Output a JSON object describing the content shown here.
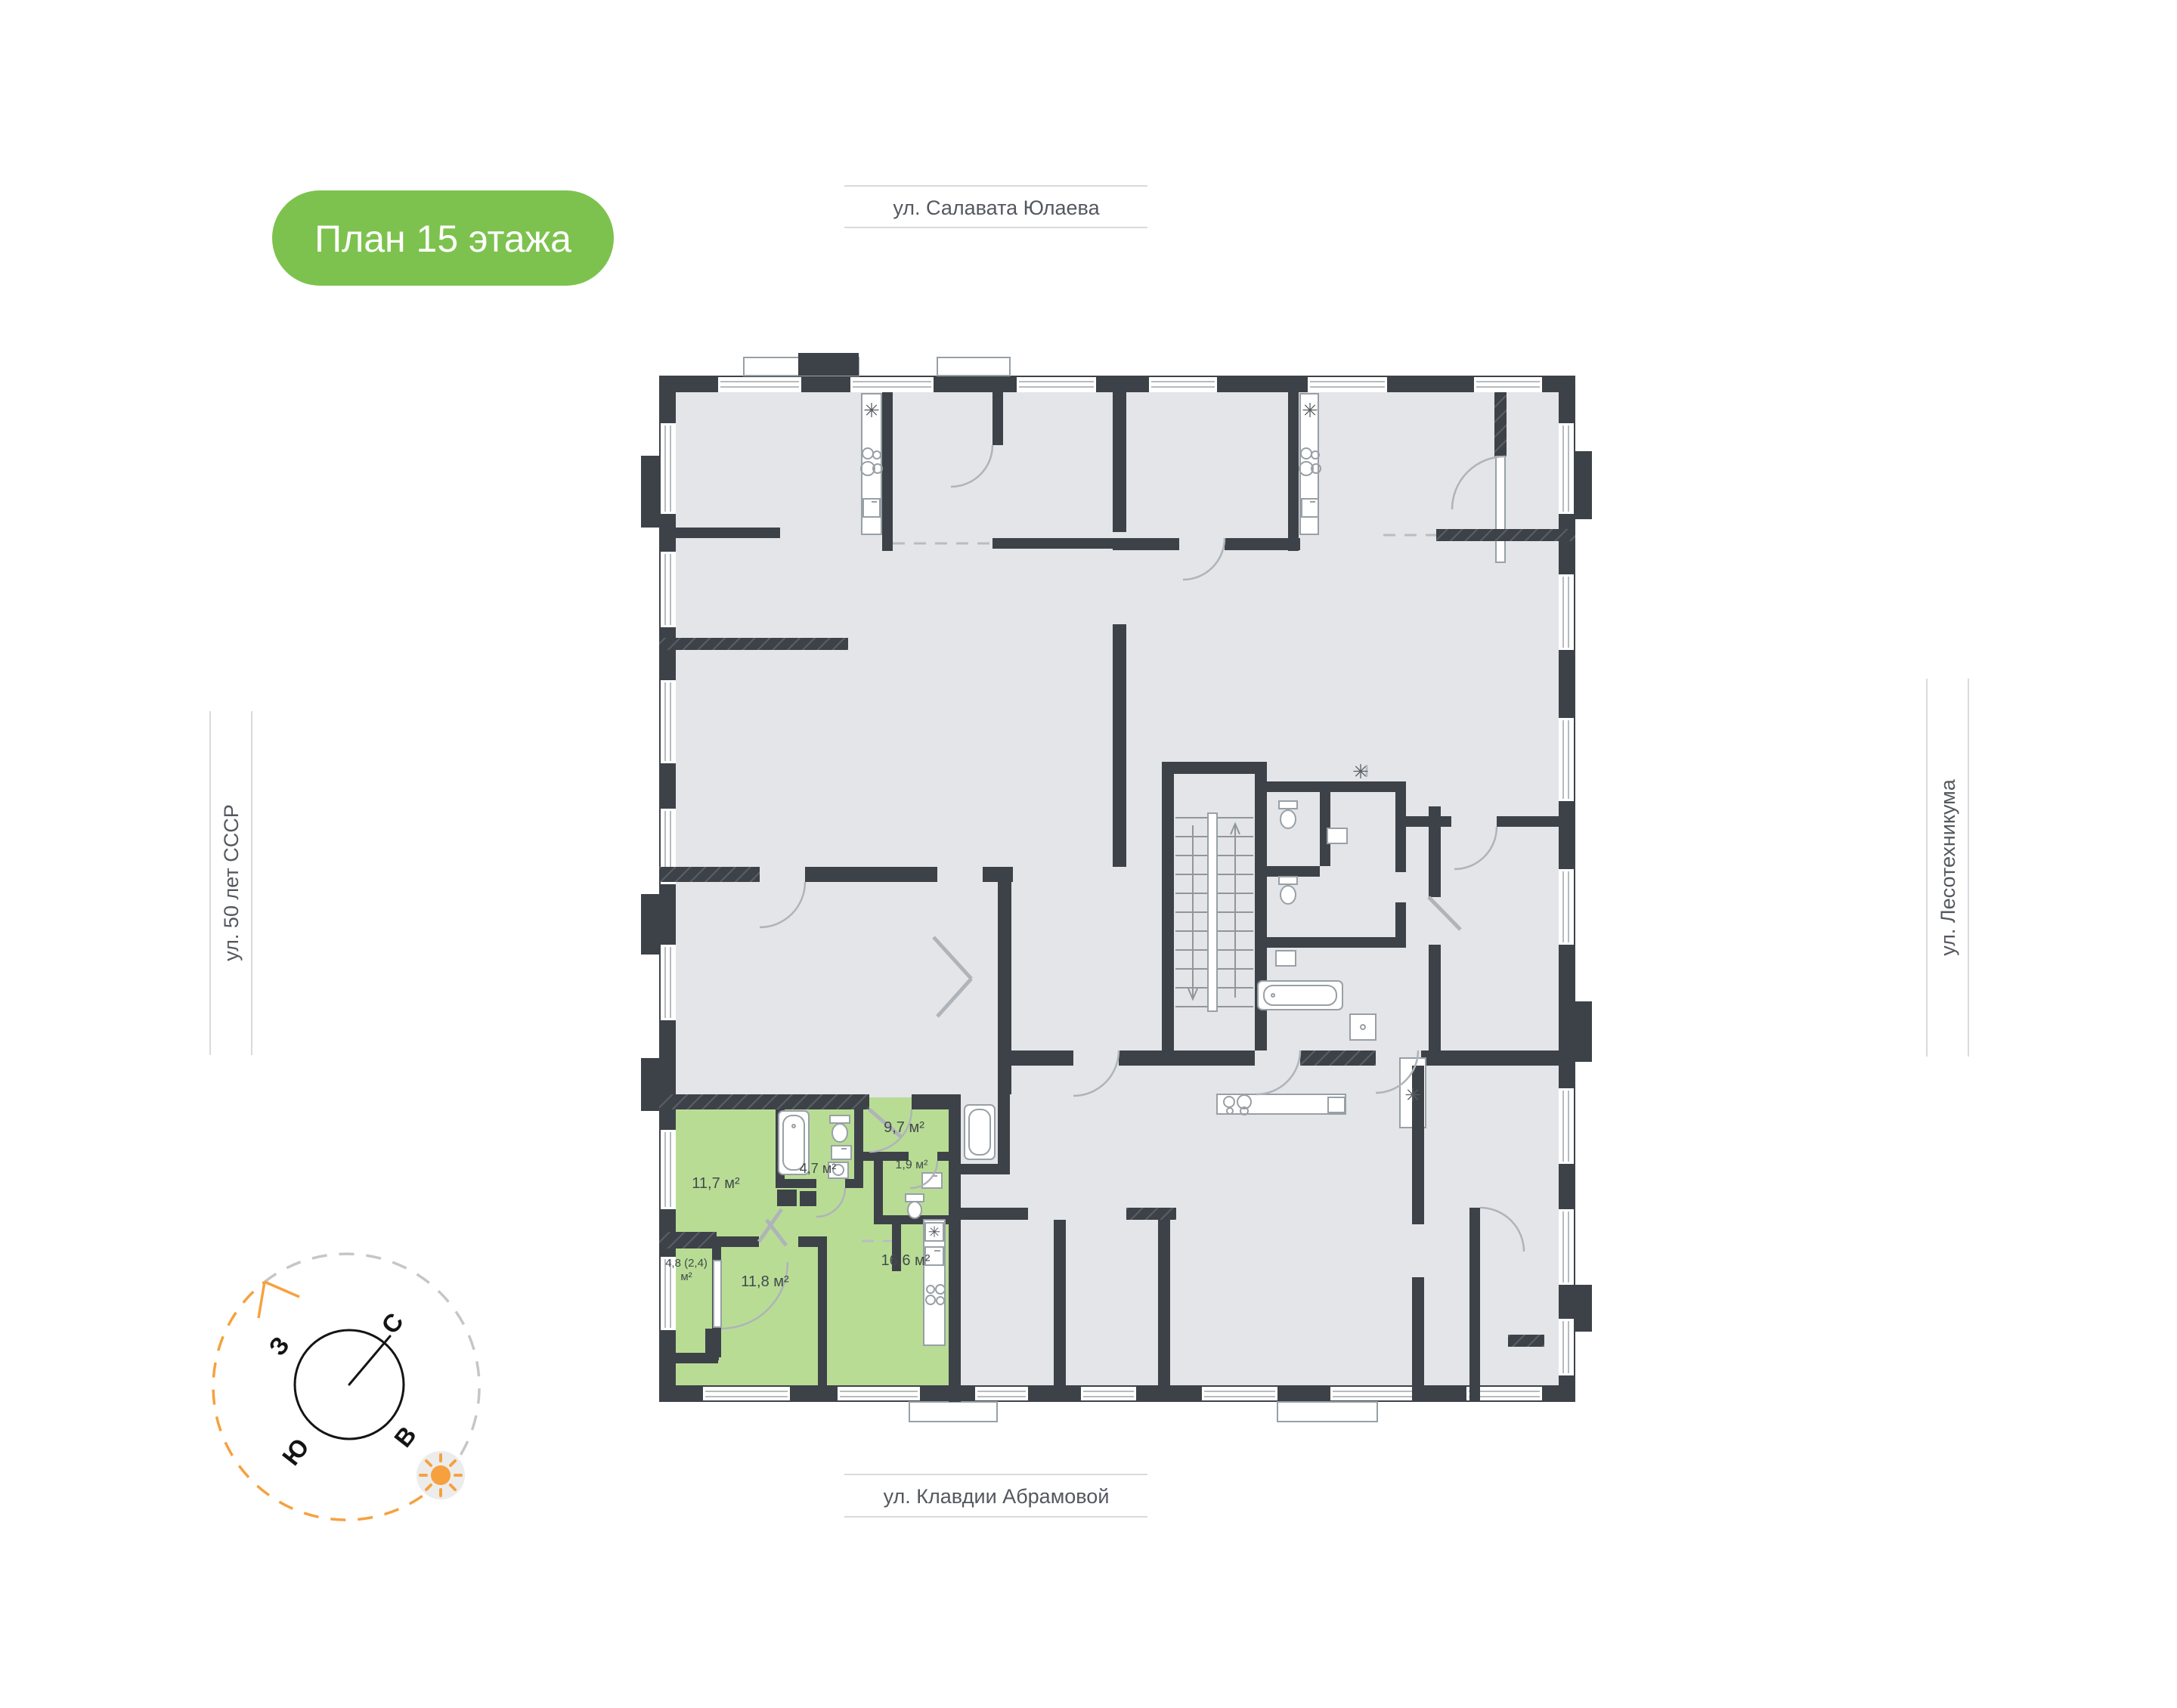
{
  "badge": {
    "label": "План 15 этажа"
  },
  "streets": {
    "top": "ул. Салавата Юлаева",
    "left": "ул. 50 лет СССР",
    "right": "ул. Лесотехникума",
    "bottom": "ул. Клавдии Абрамовой"
  },
  "compass": {
    "west": "З",
    "north": "С",
    "south": "Ю",
    "east": "В"
  },
  "apartment": {
    "rooms": [
      {
        "id": "room-1",
        "area_label": "11,7 м²"
      },
      {
        "id": "room-2",
        "area_label": "4,7 м²"
      },
      {
        "id": "room-3",
        "area_label": "9,7 м²"
      },
      {
        "id": "room-4",
        "area_label": "1,9 м²"
      },
      {
        "id": "room-5",
        "area_label": "16,6 м²"
      },
      {
        "id": "room-6",
        "area_label": "11,8 м²"
      },
      {
        "id": "room-7",
        "area_label": "4,8 (2,4)\nм²"
      }
    ]
  },
  "icons": {
    "vent_symbol": "✳"
  },
  "colors": {
    "badge_green": "#7dc24e",
    "apartment_green": "#b9dc95",
    "wall": "#3d4248",
    "floor": "#e3e5e9",
    "compass_orange": "#f6a13e"
  }
}
